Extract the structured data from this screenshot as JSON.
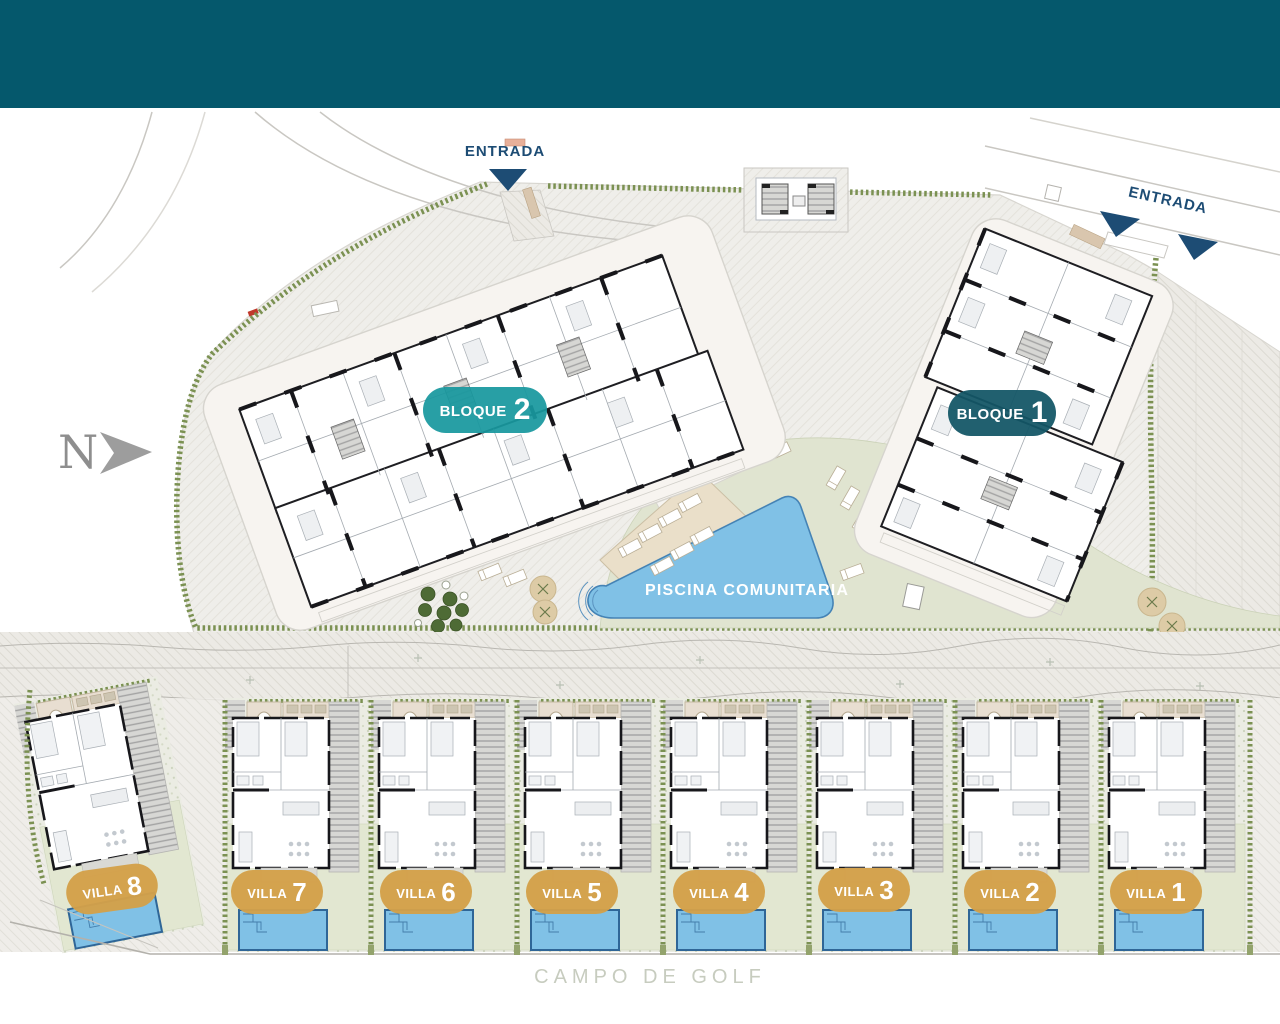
{
  "plan": {
    "north_label": "N",
    "entrance_left": "ENTRADA",
    "entrance_right": "ENTRADA",
    "block2": {
      "label": "BLOQUE",
      "number": "2"
    },
    "block1": {
      "label": "BLOQUE",
      "number": "1"
    },
    "communal_pool_label": "PISCINA COMUNITARIA",
    "golf_label": "CAMPO DE GOLF",
    "villas": [
      {
        "label": "VILLA",
        "number": "1"
      },
      {
        "label": "VILLA",
        "number": "2"
      },
      {
        "label": "VILLA",
        "number": "3"
      },
      {
        "label": "VILLA",
        "number": "4"
      },
      {
        "label": "VILLA",
        "number": "5"
      },
      {
        "label": "VILLA",
        "number": "6"
      },
      {
        "label": "VILLA",
        "number": "7"
      },
      {
        "label": "VILLA",
        "number": "8"
      }
    ],
    "colors": {
      "header_teal": "#05586c",
      "block2_teal": "#18989e",
      "block1_petrol": "#135666",
      "villa_gold": "#d3a049",
      "entrance_navy": "#1d4c74",
      "pool_blue": "#80c1e6",
      "hedge_green": "#7b9152",
      "lawn_green": "#e2e7d1"
    }
  }
}
